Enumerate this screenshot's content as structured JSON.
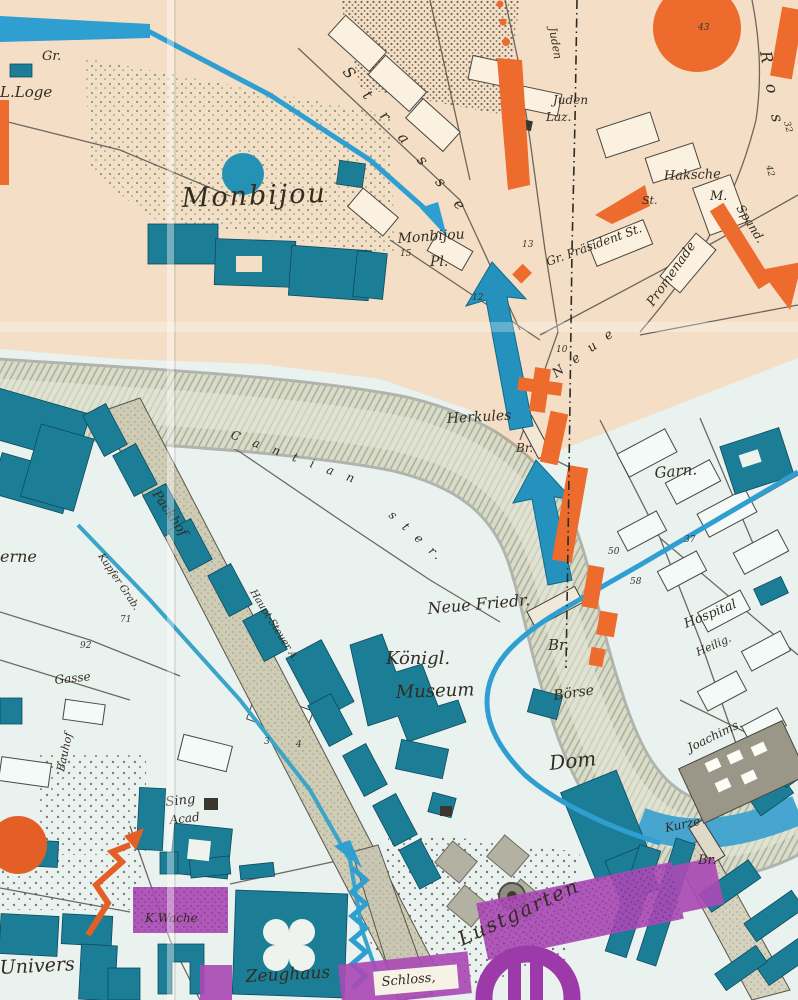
{
  "map": {
    "colors": {
      "district_north": "#f4dfc6",
      "district_south": "#eaf2ef",
      "building_teal": "#1b7e96",
      "river": "#d8dcc8",
      "rail_band": "#cfccb6",
      "route_orange": "#ec6b2d",
      "route_blue": "#2f9fd2",
      "overlay_purple": "#a94bb5"
    },
    "labels": {
      "gr": "Gr.",
      "loge": "L.Loge",
      "monbijou": "Monbijou",
      "monbijou_pl": "Monbijou",
      "pl": "Pl.",
      "strasse": "S t r a s s e",
      "juden_street": "Juden",
      "juden": "Juden",
      "laz": "Laz.",
      "haksche": "Haksche",
      "m": "M.",
      "ros": "R o s",
      "gr_praesident": "Gr. Präsident St.",
      "promenade": "Promenade",
      "spand": "Spand.",
      "st": "St.",
      "neue": "N e u e",
      "herkules": "Herkules",
      "herkules_br": "Br.",
      "garn": "Garn.",
      "hospital": "Hospital",
      "heilig": "Heilig.",
      "joachim": "Joachims.",
      "kurze": "Kurze",
      "br_se": "Br.",
      "neue_friedr": "Neue Friedr.",
      "nf_br": "Br.",
      "koenigl": "Königl.",
      "museum": "Museum",
      "boerse": "Börse",
      "dom": "Dom",
      "cantian": "C a n t i a n",
      "ster": "s t e r.",
      "packhof": "Packhof",
      "haupt_steuer": "Haupt-Steuer A.",
      "kupfer_grab": "Kupfer Grab.",
      "kaserne": "erne",
      "gasse": "Gasse",
      "bauhof": "Bauhof",
      "univers": "Univers",
      "sing": "Sing",
      "acad": "Acad",
      "k_wache": "K.Wache",
      "zeughaus": "Zeughaus",
      "schloss": "Schloss,",
      "lustgarten": "Lustgarten"
    },
    "house_numbers": [
      "15",
      "12",
      "13",
      "10",
      "50",
      "58",
      "37",
      "32",
      "42",
      "43",
      "3",
      "4",
      "71",
      "92"
    ]
  }
}
